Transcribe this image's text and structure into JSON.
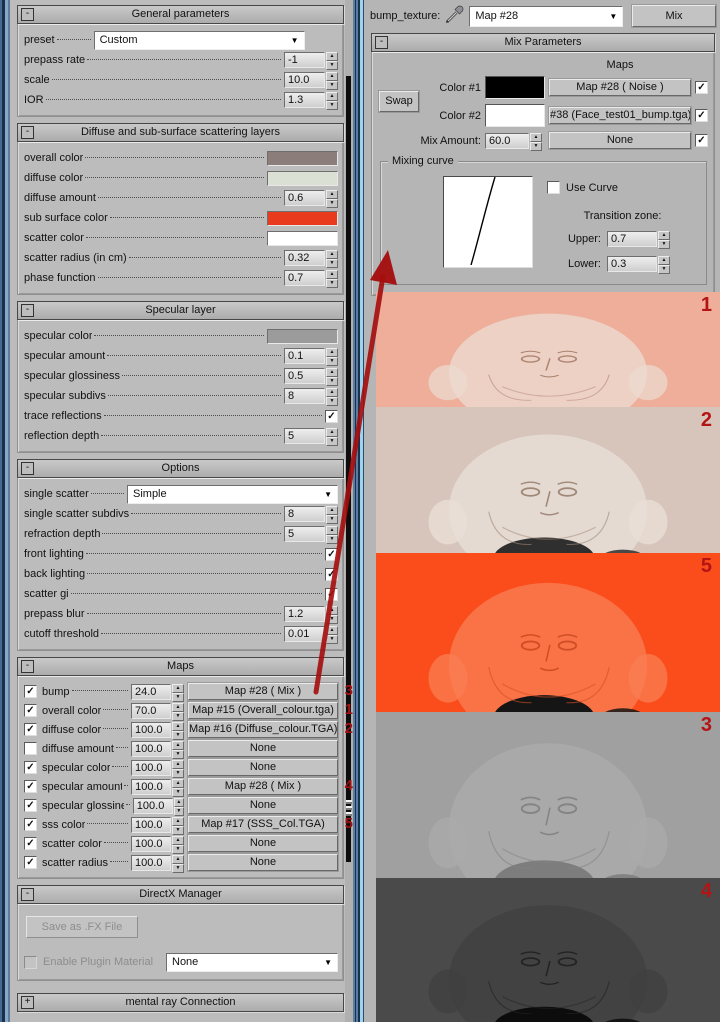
{
  "left_panel": {
    "sections": [
      {
        "title": "General parameters",
        "collapse": "-",
        "rows": [
          {
            "label": "preset",
            "control": "dropdown",
            "value": "Custom"
          },
          {
            "label": "prepass rate",
            "control": "spinner",
            "value": "-1"
          },
          {
            "label": "scale",
            "control": "spinner",
            "value": "10.0"
          },
          {
            "label": "IOR",
            "control": "spinner",
            "value": "1.3"
          }
        ]
      },
      {
        "title": "Diffuse and sub-surface scattering layers",
        "collapse": "-",
        "rows": [
          {
            "label": "overall color",
            "control": "swatch",
            "value": "#8a7d7a"
          },
          {
            "label": "diffuse color",
            "control": "swatch",
            "value": "#dae0d3"
          },
          {
            "label": "diffuse amount",
            "control": "spinner",
            "value": "0.6"
          },
          {
            "label": "sub surface color",
            "control": "swatch",
            "value": "#ea3a1d"
          },
          {
            "label": "scatter color",
            "control": "swatch",
            "value": "#ffffff"
          },
          {
            "label": "scatter radius (in cm)",
            "control": "spinner",
            "value": "0.32"
          },
          {
            "label": "phase function",
            "control": "spinner",
            "value": "0.7"
          }
        ]
      },
      {
        "title": "Specular layer",
        "collapse": "-",
        "rows": [
          {
            "label": "specular color",
            "control": "swatch",
            "value": "#9b9b9b"
          },
          {
            "label": "specular amount",
            "control": "spinner",
            "value": "0.1"
          },
          {
            "label": "specular glossiness",
            "control": "spinner",
            "value": "0.5"
          },
          {
            "label": "specular subdivs",
            "control": "spinner",
            "value": "8"
          },
          {
            "label": "trace reflections",
            "control": "checkbox",
            "checked": true
          },
          {
            "label": "reflection depth",
            "control": "spinner",
            "value": "5"
          }
        ]
      },
      {
        "title": "Options",
        "collapse": "-",
        "rows": [
          {
            "label": "single scatter",
            "control": "dropdown",
            "value": "Simple"
          },
          {
            "label": "single scatter subdivs",
            "control": "spinner",
            "value": "8"
          },
          {
            "label": "refraction depth",
            "control": "spinner",
            "value": "5"
          },
          {
            "label": "front lighting",
            "control": "checkbox",
            "checked": true
          },
          {
            "label": "back lighting",
            "control": "checkbox",
            "checked": true
          },
          {
            "label": "scatter gi",
            "control": "checkbox",
            "checked": true
          },
          {
            "label": "prepass blur",
            "control": "spinner",
            "value": "1.2"
          },
          {
            "label": "cutoff threshold",
            "control": "spinner",
            "value": "0.01"
          }
        ]
      },
      {
        "title": "Maps",
        "collapse": "-",
        "maps_rows": [
          {
            "enabled": true,
            "label": "bump",
            "amount": "24.0",
            "map_button": "Map #28  ( Mix )",
            "annotation": "3"
          },
          {
            "enabled": true,
            "label": "overall color",
            "amount": "70.0",
            "map_button": "Map #15 (Overall_colour.tga)",
            "annotation": "1"
          },
          {
            "enabled": true,
            "label": "diffuse color",
            "amount": "100.0",
            "map_button": "Map #16 (Diffuse_colour.TGA)",
            "annotation": "2"
          },
          {
            "enabled": false,
            "label": "diffuse amount",
            "amount": "100.0",
            "map_button": "None",
            "annotation": ""
          },
          {
            "enabled": true,
            "label": "specular color",
            "amount": "100.0",
            "map_button": "None",
            "annotation": ""
          },
          {
            "enabled": true,
            "label": "specular amount",
            "amount": "100.0",
            "map_button": "Map #28  ( Mix )",
            "annotation": "4"
          },
          {
            "enabled": true,
            "label": "specular glossiness",
            "amount": "100.0",
            "map_button": "None",
            "annotation": ""
          },
          {
            "enabled": true,
            "label": "sss color",
            "amount": "100.0",
            "map_button": "Map #17 (SSS_Col.TGA)",
            "annotation": "5"
          },
          {
            "enabled": true,
            "label": "scatter color",
            "amount": "100.0",
            "map_button": "None",
            "annotation": ""
          },
          {
            "enabled": true,
            "label": "scatter radius",
            "amount": "100.0",
            "map_button": "None",
            "annotation": ""
          }
        ]
      }
    ],
    "directx": {
      "title": "DirectX Manager",
      "collapse": "-",
      "save_button": "Save as .FX File",
      "enable_checkbox_label": "Enable Plugin Material",
      "plugin_dropdown_value": "None"
    },
    "mental_ray": {
      "title": "mental ray Connection",
      "collapse": "+"
    }
  },
  "right_panel": {
    "header": {
      "slot_label": "bump_texture:",
      "map_dropdown_value": "Map #28",
      "type_button_label": "Mix"
    },
    "mix_parameters": {
      "title": "Mix Parameters",
      "collapse": "-",
      "maps_column_header": "Maps",
      "swap_button_label": "Swap",
      "color1_label": "Color #1",
      "color1_swatch": "#000000",
      "color1_map_button": "Map #28  ( Noise )",
      "color1_map_enabled": true,
      "color2_label": "Color #2",
      "color2_swatch": "#ffffff",
      "color2_map_button": "#38 (Face_test01_bump.tga)",
      "color2_map_enabled": true,
      "mix_amount_label": "Mix Amount:",
      "mix_amount_value": "60.0",
      "mix_amount_map_button": "None",
      "mix_amount_map_enabled": true,
      "mixing_curve": {
        "group_label": "Mixing curve",
        "use_curve_label": "Use Curve",
        "use_curve_checked": false,
        "transition_zone_label": "Transition zone:",
        "upper_label": "Upper:",
        "upper_value": "0.7",
        "lower_label": "Lower:",
        "lower_value": "0.3"
      }
    },
    "texture_previews": [
      {
        "number": "1",
        "bg": "#eeae9a",
        "face": "#ecdacf",
        "feature": "#b08673",
        "blob": ""
      },
      {
        "number": "2",
        "bg": "#d7c5bb",
        "face": "#e9dfd7",
        "feature": "#a08878",
        "blob": "#2f2f2f"
      },
      {
        "number": "5",
        "bg": "#fb4d1c",
        "face": "#f97d52",
        "feature": "#d14e24",
        "blob": "#151515"
      },
      {
        "number": "3",
        "bg": "#a0a0a0",
        "face": "#ababab",
        "feature": "#848484",
        "blob": "#7d7d7d"
      },
      {
        "number": "4",
        "bg": "#4a4a4a",
        "face": "#404040",
        "feature": "#232323",
        "blob": "#0c0c0c"
      }
    ],
    "annotation_color": "#a50d0d"
  }
}
